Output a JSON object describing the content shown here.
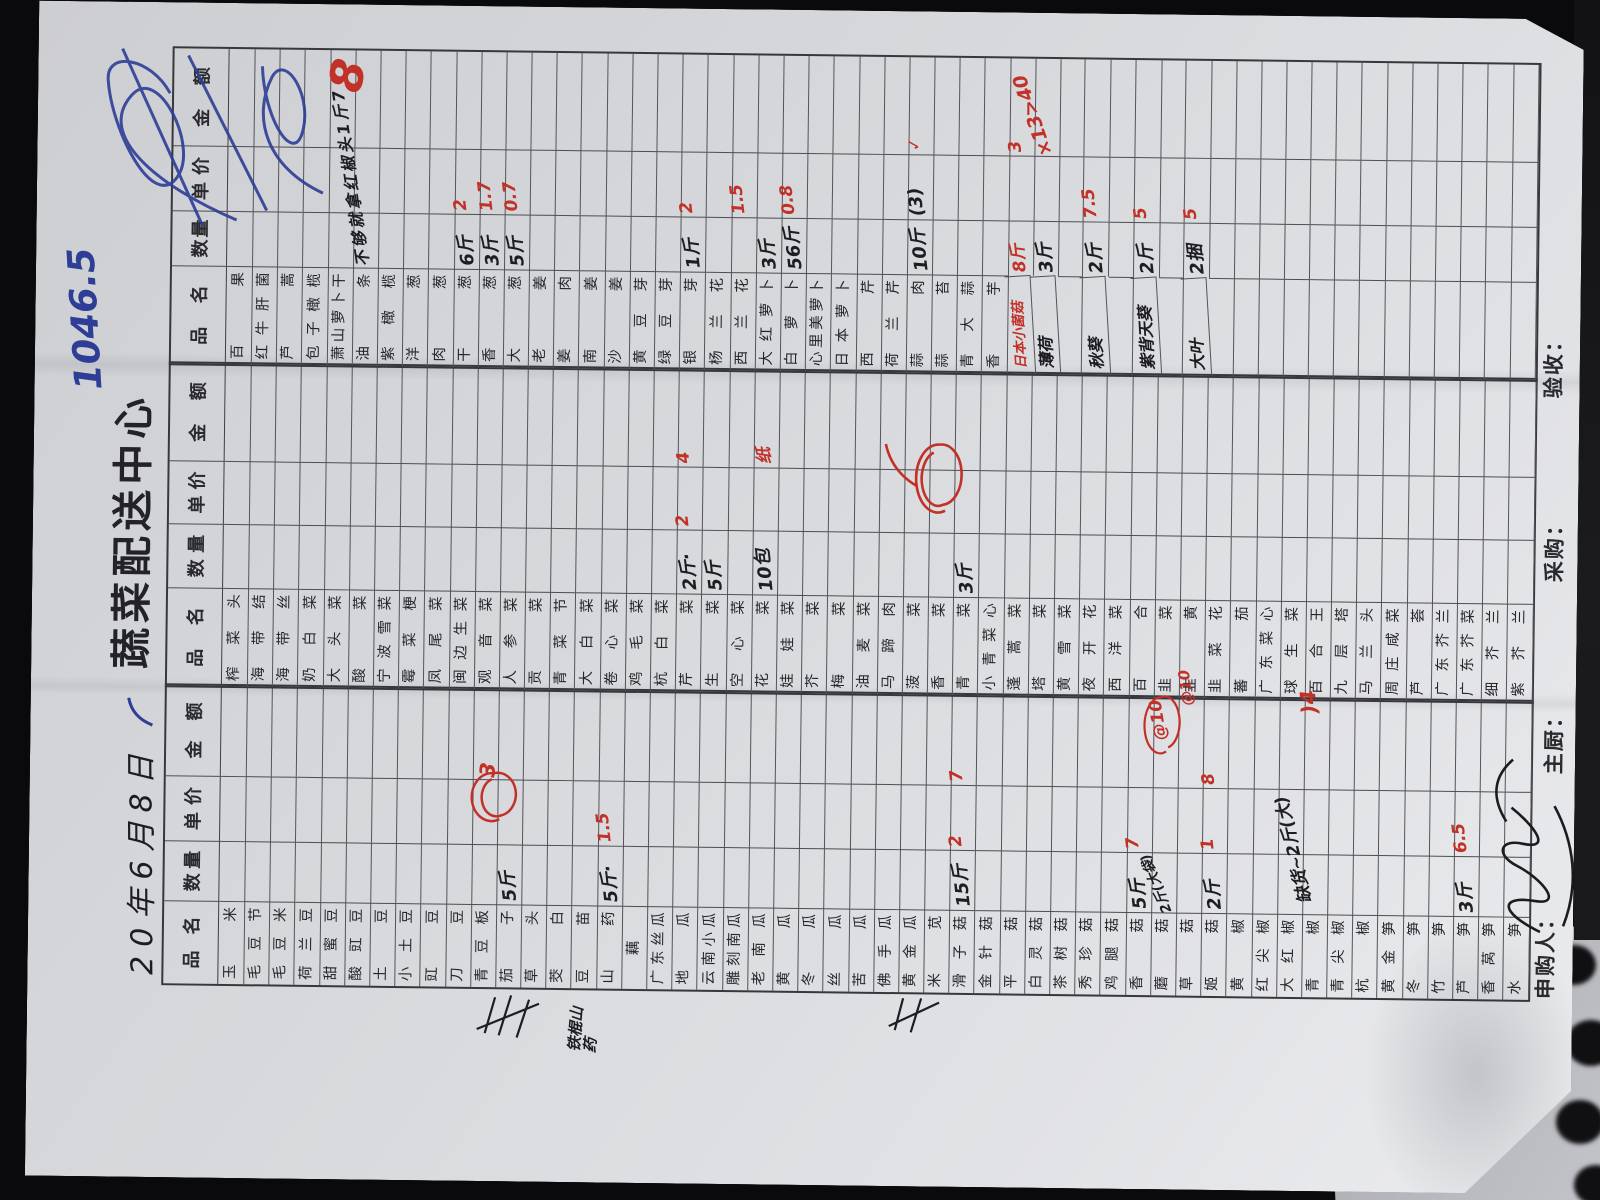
{
  "palette": {
    "paper": "#d6d8db",
    "background": "#0a0a0c",
    "grid_line": "#4e4e54",
    "printed_ink": "#26262a",
    "pen_black": "#1d1d22",
    "pen_red": "#c23128",
    "pen_blue": "#2e3d96",
    "desk": "#b4b5ba"
  },
  "title": "蔬菜配送中心",
  "date_text": "20年6月8日",
  "top_notes": {
    "blue_total": "1046.5",
    "red_margin_number": "8",
    "black_diagonal_note": "不够就拿红椒头1斤7"
  },
  "margin_note": "铁棍山药",
  "headers": {
    "name": "品名",
    "qty": "数量",
    "price": "单价",
    "amount": "金额"
  },
  "footer": {
    "applicant": "申购人：",
    "chef": "主厨：",
    "buyer": "采购：",
    "inspector": "验收："
  },
  "table": {
    "groups": [
      {
        "id": "group-1",
        "rows": [
          [
            "玉米"
          ],
          [
            "毛豆节"
          ],
          [
            "毛豆米"
          ],
          [
            "荷兰豆"
          ],
          [
            "甜蜜豆"
          ],
          [
            "酸豇豆"
          ],
          [
            "土豆"
          ],
          [
            "小土豆"
          ],
          [
            "豇豆"
          ],
          [
            "刀豆"
          ],
          [
            "青豆板"
          ],
          [
            "茄子",
            "5斤",
            "",
            ""
          ],
          [
            "草头"
          ],
          [
            "茭白"
          ],
          [
            "豆苗"
          ],
          [
            "山药",
            "5斤·",
            "1.5",
            ""
          ],
          [
            "藕"
          ],
          [
            "广东丝瓜"
          ],
          [
            "地瓜"
          ],
          [
            "云南小瓜"
          ],
          [
            "雕刻南瓜"
          ],
          [
            "老南瓜"
          ],
          [
            "黄瓜"
          ],
          [
            "冬瓜"
          ],
          [
            "丝瓜"
          ],
          [
            "苦瓜"
          ],
          [
            "佛手瓜"
          ],
          [
            "黄金瓜"
          ],
          [
            "米苋"
          ],
          [
            "滑子菇",
            "15斤",
            "2",
            "7"
          ],
          [
            "金针菇"
          ],
          [
            "平菇"
          ],
          [
            "白灵菇"
          ],
          [
            "茶树菇"
          ],
          [
            "秀珍菇"
          ],
          [
            "鸡腿菇"
          ],
          [
            "香菇",
            "5斤",
            "7",
            ""
          ],
          [
            "蘑菇",
            "2斤(大袋)",
            "",
            "",
            "qt"
          ],
          [
            "草菇"
          ],
          [
            "姬菇",
            "2斤",
            "1",
            "8"
          ],
          [
            "黄椒"
          ],
          [
            "红尖椒"
          ],
          [
            "大红椒"
          ],
          [
            "青椒"
          ],
          [
            "青尖椒"
          ],
          [
            "杭椒"
          ],
          [
            "黄金笋"
          ],
          [
            "冬笋"
          ],
          [
            "竹笋"
          ],
          [
            "芦笋",
            "3斤",
            "6.5",
            ""
          ],
          [
            "香莴笋"
          ],
          [
            "水笋"
          ]
        ]
      },
      {
        "id": "group-2",
        "rows": [
          [
            "榨菜头"
          ],
          [
            "海带结"
          ],
          [
            "海带丝"
          ],
          [
            "奶白菜"
          ],
          [
            "大头菜"
          ],
          [
            "酸菜"
          ],
          [
            "宁波雪菜"
          ],
          [
            "霉菜梗"
          ],
          [
            "凤尾菜"
          ],
          [
            "闽边生菜"
          ],
          [
            "观音菜"
          ],
          [
            "人参菜"
          ],
          [
            "贡菜"
          ],
          [
            "青菜节"
          ],
          [
            "大白菜"
          ],
          [
            "卷心菜"
          ],
          [
            "鸡毛菜"
          ],
          [
            "杭白菜"
          ],
          [
            "芹菜",
            "2斤·",
            "2",
            "4"
          ],
          [
            "生菜",
            "5斤",
            "",
            ""
          ],
          [
            "空心菜"
          ],
          [
            "花菜",
            "10包",
            "",
            "纸"
          ],
          [
            "娃娃菜"
          ],
          [
            "芥菜"
          ],
          [
            "梅菜"
          ],
          [
            "油麦菜"
          ],
          [
            "马蹄肉"
          ],
          [
            "菠菜"
          ],
          [
            "香菜"
          ],
          [
            "青菜",
            "3斤",
            "",
            ""
          ],
          [
            "小青菜心"
          ],
          [
            "蓬蒿菜"
          ],
          [
            "塔菜"
          ],
          [
            "黄雪菜"
          ],
          [
            "夜开花"
          ],
          [
            "西洋菜"
          ],
          [
            "百合"
          ],
          [
            "韭菜"
          ],
          [
            "韭黄"
          ],
          [
            "韭菜花"
          ],
          [
            "蕃茄"
          ],
          [
            "广东菜心"
          ],
          [
            "球生菜"
          ],
          [
            "百合王"
          ],
          [
            "九层塔"
          ],
          [
            "马兰头"
          ],
          [
            "周庄咸菜"
          ],
          [
            "芦荟"
          ],
          [
            "广东芥兰"
          ],
          [
            "广东芥菜"
          ],
          [
            "细芥兰"
          ],
          [
            "紫芥兰"
          ]
        ]
      },
      {
        "id": "group-3",
        "rows": [
          [
            "百果"
          ],
          [
            "红牛肝菌"
          ],
          [
            "芦蒿"
          ],
          [
            "包子橄榄"
          ],
          [
            "萧山萝卜干"
          ],
          [
            "油条"
          ],
          [
            "紫橄榄"
          ],
          [
            "洋葱"
          ],
          [
            "肉葱"
          ],
          [
            "干葱",
            "6斤",
            "2",
            ""
          ],
          [
            "香葱",
            "3斤",
            "1.7",
            ""
          ],
          [
            "大葱",
            "5斤",
            "0.7",
            ""
          ],
          [
            "老姜"
          ],
          [
            "姜肉"
          ],
          [
            "南姜"
          ],
          [
            "沙姜"
          ],
          [
            "黄豆芽"
          ],
          [
            "绿豆芽"
          ],
          [
            "银芽",
            "1斤",
            "2",
            ""
          ],
          [
            "杨兰花"
          ],
          [
            "西兰花",
            "",
            "1.5",
            ""
          ],
          [
            "大红萝卜",
            "3斤",
            "",
            ""
          ],
          [
            "白萝卜",
            "56斤",
            "0.8",
            ""
          ],
          [
            "心里美萝卜"
          ],
          [
            "日本萝卜"
          ],
          [
            "西芹"
          ],
          [
            "荷兰芹"
          ],
          [
            "蒜肉",
            "10斤",
            "(3)",
            "✓",
            "pk"
          ],
          [
            "蒜苔"
          ],
          [
            "青大蒜"
          ],
          [
            "香芋"
          ],
          [
            "日本小菌菇",
            "8斤",
            "",
            "3",
            "R qr"
          ],
          [
            "薄荷",
            "3斤",
            "",
            "",
            "H"
          ],
          [
            ""
          ],
          [
            "秋葵",
            "2斤",
            "7.5",
            "",
            "H"
          ],
          [
            ""
          ],
          [
            "紫背天葵",
            "2斤",
            "5",
            "",
            "H"
          ],
          [
            ""
          ],
          [
            "大叶",
            "2捆",
            "5",
            "",
            "H"
          ],
          [
            ""
          ],
          [
            ""
          ],
          [
            ""
          ],
          [
            ""
          ],
          [
            ""
          ],
          [
            ""
          ],
          [
            ""
          ],
          [
            ""
          ],
          [
            ""
          ],
          [
            ""
          ],
          [
            ""
          ],
          [
            ""
          ],
          [
            ""
          ]
        ]
      }
    ]
  },
  "overlays": [
    {
      "t": "1046.5",
      "x": 786,
      "y": 28,
      "s": 37,
      "c": "blue",
      "r": -4,
      "name": "blue-total-note"
    },
    {
      "t": "8",
      "x": 1088,
      "y": 282,
      "s": 46,
      "c": "red",
      "r": 12,
      "name": "red-margin-number"
    },
    {
      "t": "不够就拿红椒头1斤7",
      "x": 912,
      "y": 300,
      "s": 16,
      "c": "ink",
      "r": -9,
      "ls": 3,
      "name": "black-diagonal-note"
    },
    {
      "t": "×13>40",
      "x": 1030,
      "y": 984,
      "s": 19,
      "c": "red",
      "r": -20,
      "name": "red-calc-note-mint"
    },
    {
      "t": "@10",
      "x": 449,
      "y": 1118,
      "s": 17,
      "c": "red",
      "r": -10,
      "name": "red-price-note-mushroom"
    },
    {
      "t": "@10",
      "x": 484,
      "y": 1146,
      "s": 15,
      "c": "red",
      "r": -8,
      "name": "red-price-note-chive"
    },
    {
      "t": ")4",
      "x": 477,
      "y": 1266,
      "s": 21,
      "c": "red",
      "r": -6,
      "name": "red-note-lilybulb"
    },
    {
      "t": "缺货~2斤(大)",
      "x": 286,
      "y": 1250,
      "s": 17,
      "c": "ink",
      "r": -14,
      "name": "out-of-stock-note"
    },
    {
      "t": "铁棍山药",
      "x": 130,
      "y": 542,
      "s": 15,
      "c": "ink",
      "r": 4,
      "w": 46,
      "name": "margin-note-yam"
    },
    {
      "t": "3",
      "x": 404,
      "y": 446,
      "s": 21,
      "c": "red",
      "r": 6,
      "name": "red-price-eggplant"
    }
  ]
}
